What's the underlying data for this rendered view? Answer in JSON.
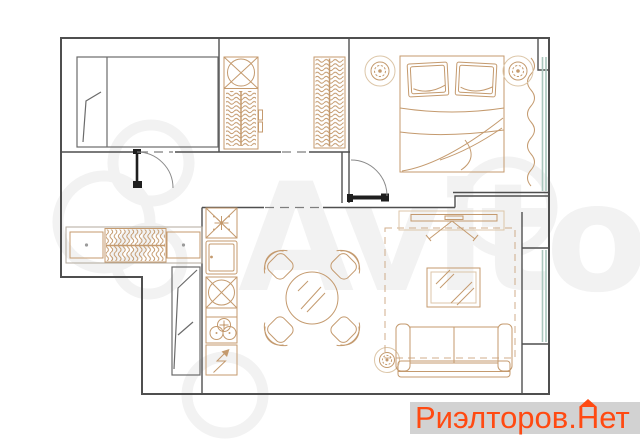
{
  "watermark": {
    "text": "Avito"
  },
  "brand": {
    "prefix": "Риэлторов",
    "dot": ".",
    "house_letter": "Н",
    "suffix": "ет"
  },
  "colors": {
    "background": "#ffffff",
    "wall": "#4f4f4f",
    "dark": "#1f1f1f",
    "furniture": "#c49a6e",
    "furniture_light": "#dcc6a8",
    "glass": "#a9c7bd",
    "watermark": "#f2f2f2",
    "brand_text": "#ff4a12",
    "brand_bg": "#d2d2d2"
  },
  "icons": {
    "house_roof": "roof-triangle-over-letter-N",
    "ceiling_light": "gear-circle",
    "hood": "asterisk-in-crossed-box",
    "sink": "ellipse-in-crossed-box",
    "stove": "three-burner-circles",
    "electric": "lightning-arrow"
  }
}
